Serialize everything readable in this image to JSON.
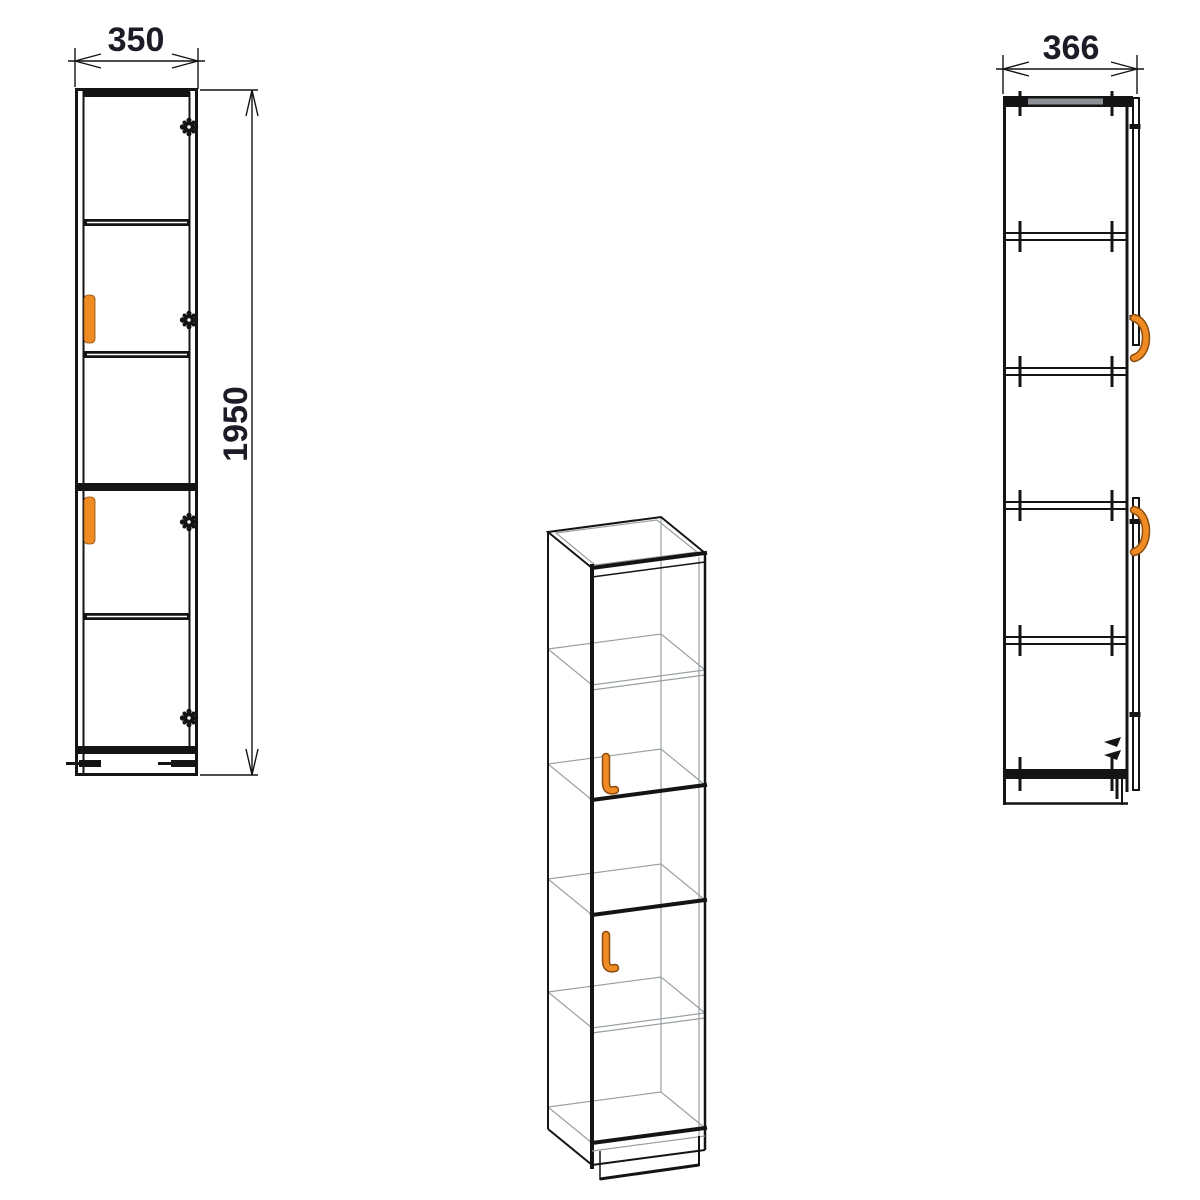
{
  "views": {
    "front": {
      "width_label": "350",
      "height_label": "1950"
    },
    "side": {
      "depth_label": "366"
    }
  },
  "colors": {
    "background": "#ffffff",
    "line": "#141414",
    "dim_text": "#1c1c26",
    "handle_orange": "#EF8B22",
    "handle_shadow": "#8a4d12",
    "wireframe_gray": "#9aa0a4",
    "panel_gray": "#8c9094"
  },
  "icons": {
    "hinge": "gear-blob",
    "screw": "tick-cross",
    "front_handle": "vertical-bar",
    "side_handle": "c-arc",
    "iso_handle": "j-bar",
    "dim_arrow": "open-v"
  }
}
